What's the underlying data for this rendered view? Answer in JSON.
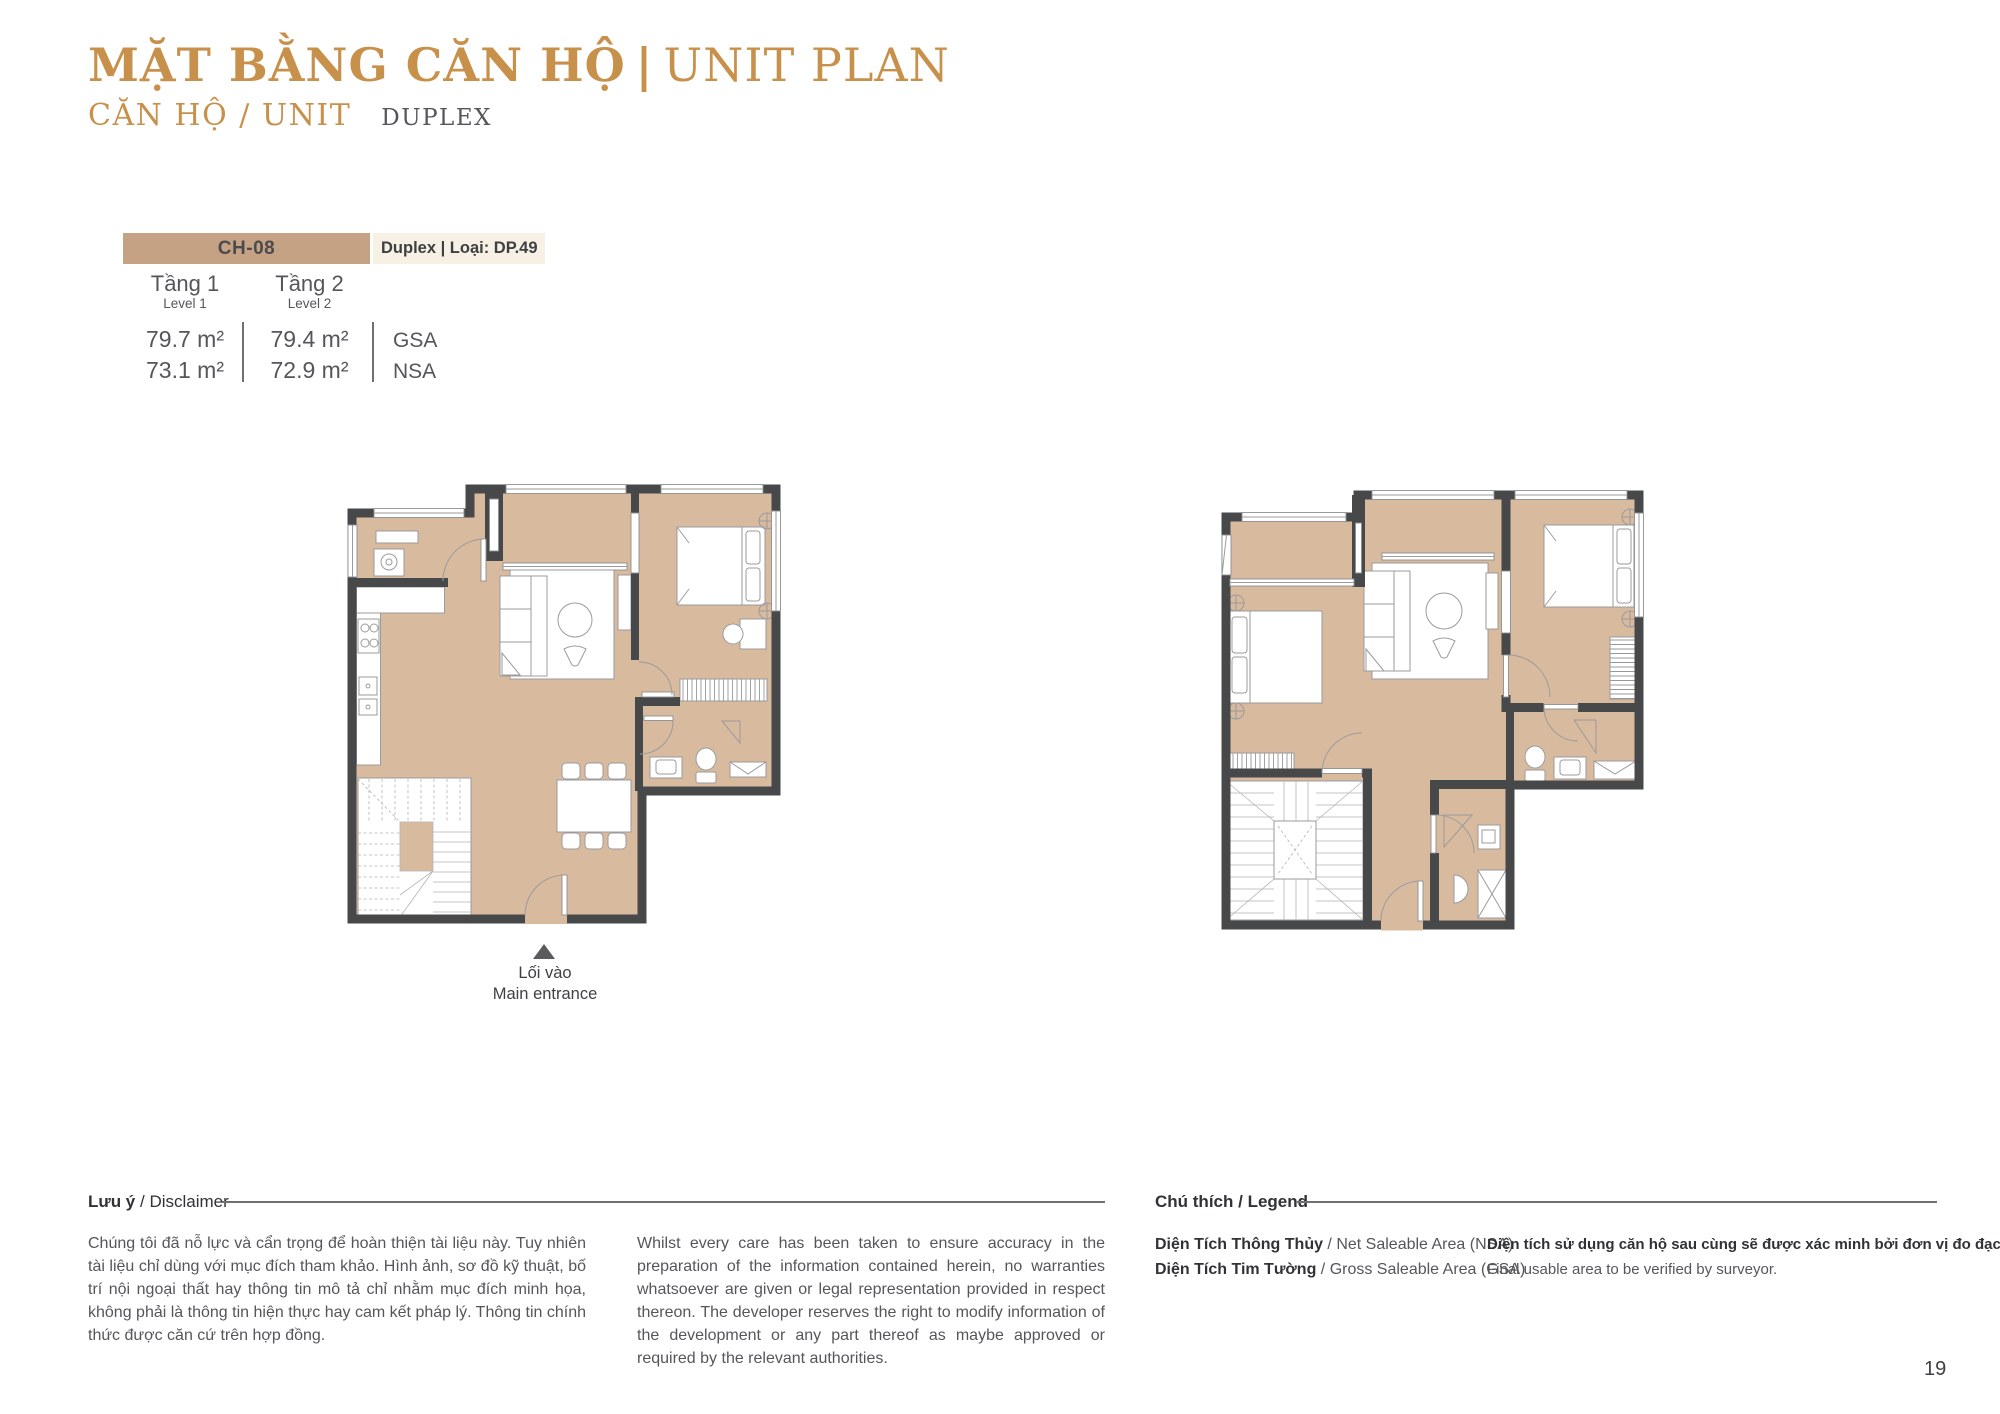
{
  "header": {
    "title_vi": "MẶT BẰNG CĂN HỘ",
    "title_divider": "|",
    "title_en": "UNIT PLAN",
    "subtitle_label": "CĂN HỘ / UNIT",
    "subtitle_value": "DUPLEX"
  },
  "unit_info": {
    "code": "CH-08",
    "type_label": "Duplex | Loại: DP.49",
    "levels": [
      {
        "name_vi": "Tầng 1",
        "name_en": "Level 1",
        "gsa": "79.7 m²",
        "nsa": "73.1 m²"
      },
      {
        "name_vi": "Tầng 2",
        "name_en": "Level 2",
        "gsa": "79.4 m²",
        "nsa": "72.9 m²"
      }
    ],
    "gsa_label": "GSA",
    "nsa_label": "NSA"
  },
  "plan": {
    "entrance_vi": "Lối vào",
    "entrance_en": "Main entrance"
  },
  "disclaimer": {
    "heading_vi": "Lưu ý",
    "heading_sep": " / ",
    "heading_en": "Disclaimer",
    "body_vi": "Chúng tôi đã nỗ lực và cẩn trọng để hoàn thiện tài liệu này. Tuy nhiên tài liệu chỉ dùng với mục đích tham khảo. Hình ảnh, sơ đồ kỹ thuật, bố trí nội ngoại thất hay thông tin mô tả chỉ nhằm mục đích minh họa, không phải là thông tin hiện thực hay cam kết pháp lý. Thông tin chính thức được căn cứ trên hợp đồng.",
    "body_en": "Whilst every care has been taken to ensure accuracy in the preparation of the information contained herein, no warranties whatsoever are given or legal representation provided in respect thereon. The developer reserves the right to modify information of the development or any part thereof as maybe approved or required by the relevant authorities."
  },
  "legend": {
    "heading_vi": "Chú thích",
    "heading_sep": " / ",
    "heading_en": "Legend",
    "items": [
      {
        "vi": "Diện Tích Thông Thủy",
        "sep": " / ",
        "en": "Net Saleable Area (NSA)"
      },
      {
        "vi": "Diện Tích Tim Tường",
        "sep": " / ",
        "en": "Gross Saleable Area (GSA)"
      }
    ],
    "note_vi": "Diện tích sử dụng căn hộ sau cùng sẽ được xác minh bởi đơn vị đo đạc.",
    "note_en": "Final usable area to be verified by surveyor."
  },
  "page_number": "19",
  "colors": {
    "accent_gold": "#C8914B",
    "unit_box_tan": "#C6A284",
    "unit_box_cream": "#F7F0E5",
    "wall": "#47484A",
    "floor": "#D8BA9E",
    "text_gray": "#55565A"
  }
}
